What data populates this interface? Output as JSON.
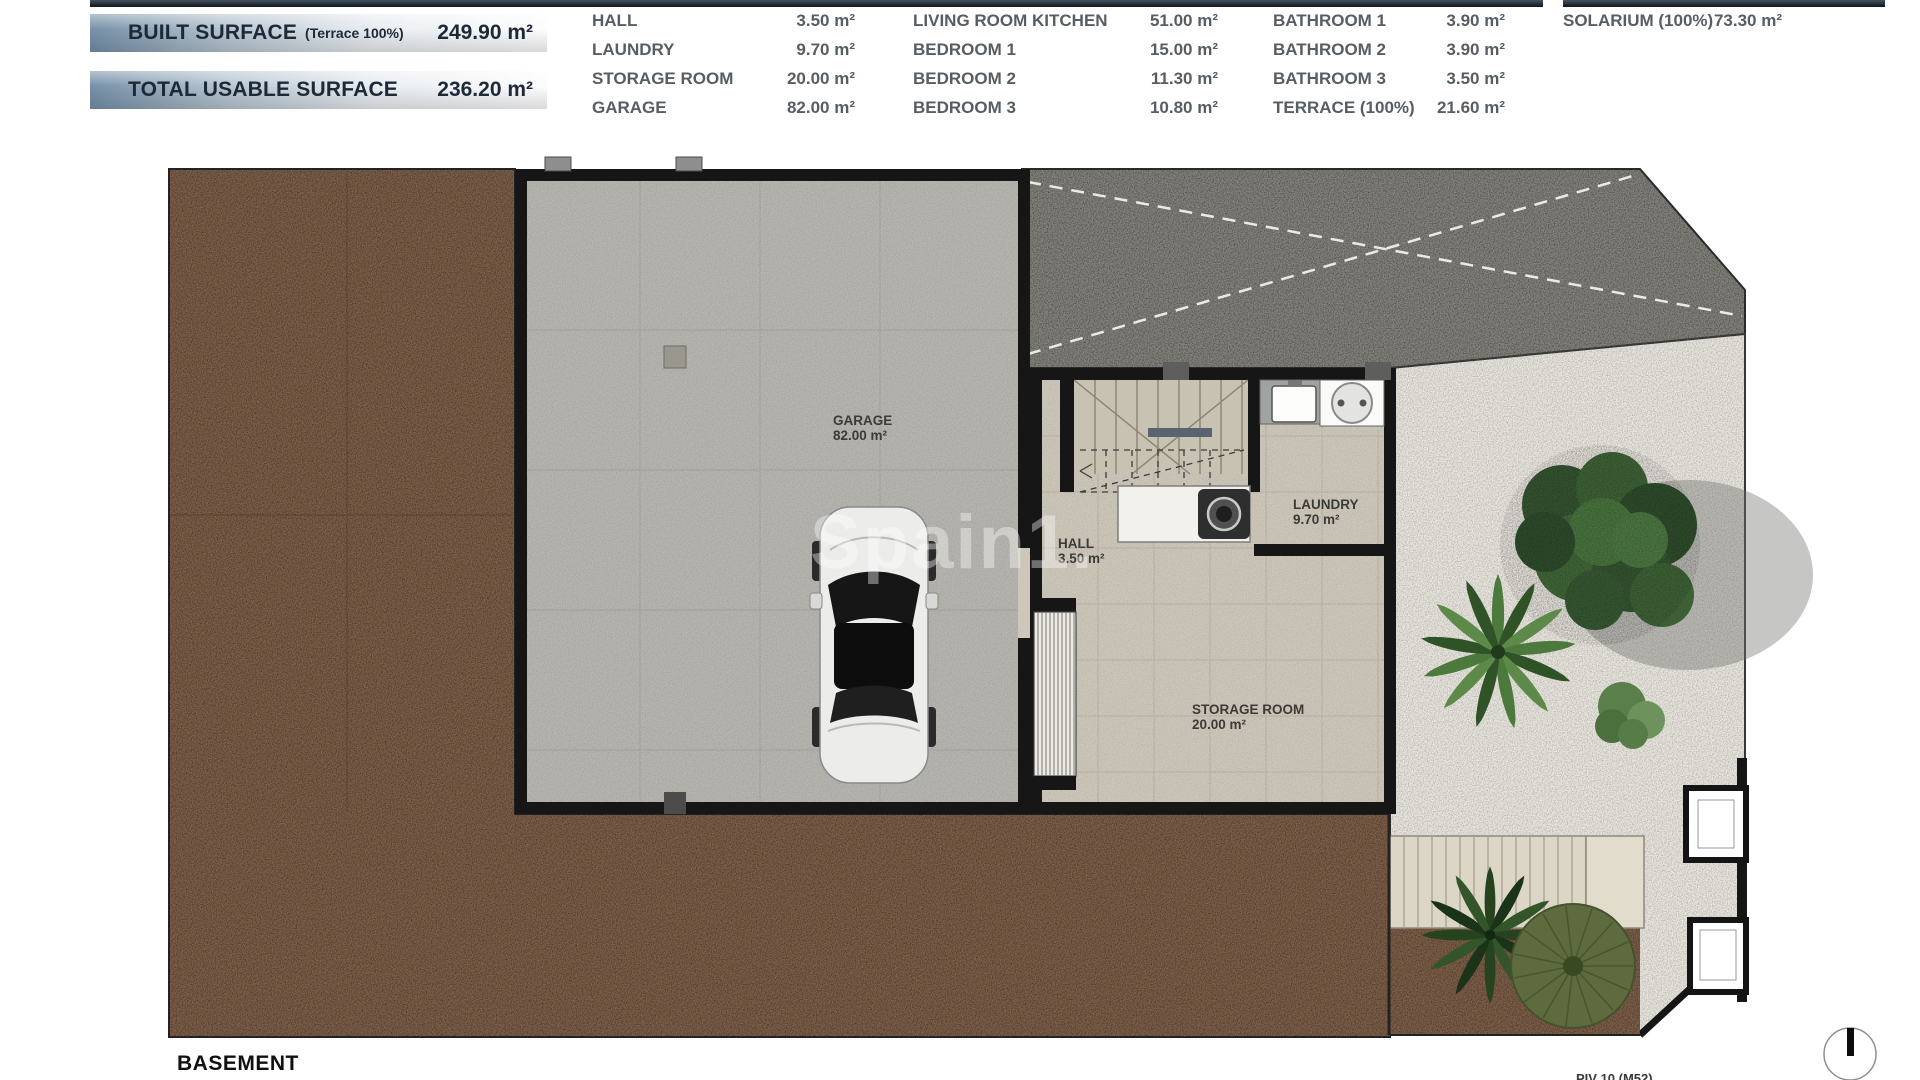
{
  "header": {
    "banners": [
      {
        "label": "BUILT SURFACE",
        "note": "(Terrace 100%)",
        "value": "249.90 m²"
      },
      {
        "label": "TOTAL USABLE SURFACE",
        "note": "",
        "value": "236.20 m²"
      }
    ],
    "legend_columns": [
      {
        "rows": [
          {
            "label": "HALL",
            "value": "3.50 m²"
          },
          {
            "label": "LAUNDRY",
            "value": "9.70 m²"
          },
          {
            "label": "STORAGE ROOM",
            "value": "20.00 m²"
          },
          {
            "label": "GARAGE",
            "value": "82.00 m²"
          }
        ]
      },
      {
        "rows": [
          {
            "label": "LIVING ROOM KITCHEN",
            "value": "51.00 m²"
          },
          {
            "label": "BEDROOM 1",
            "value": "15.00 m²"
          },
          {
            "label": "BEDROOM 2",
            "value": "11.30 m²"
          },
          {
            "label": "BEDROOM 3",
            "value": "10.80 m²"
          }
        ]
      },
      {
        "rows": [
          {
            "label": "BATHROOM 1",
            "value": "3.90 m²"
          },
          {
            "label": "BATHROOM 2",
            "value": "3.90 m²"
          },
          {
            "label": "BATHROOM 3",
            "value": "3.50 m²"
          },
          {
            "label": "TERRACE (100%)",
            "value": "21.60 m²"
          }
        ]
      },
      {
        "rows": [
          {
            "label": "SOLARIUM (100%)",
            "value": "73.30 m²"
          }
        ]
      }
    ]
  },
  "plan": {
    "floor_label": "BASEMENT",
    "watermark": "Spain1.",
    "footer_note": "PIV 10 (M52)",
    "room_labels": [
      {
        "name": "GARAGE",
        "area": "82.00 m²"
      },
      {
        "name": "HALL",
        "area": "3.50 m²"
      },
      {
        "name": "LAUNDRY",
        "area": "9.70 m²"
      },
      {
        "name": "STORAGE ROOM",
        "area": "20.00 m²"
      }
    ]
  },
  "colors": {
    "banner_blue": "#7590a8",
    "banner_text": "#1d2936",
    "legend_text": "#565e64",
    "gravel_brown": "#7a5a43",
    "driveway_gray": "#82817a",
    "garden_gravel": "#eae7e0",
    "garage_floor": "#b7b5b0",
    "interior_floor": "#cdc7ba",
    "wall_black": "#161616",
    "tree_green": "#3c5f35"
  }
}
